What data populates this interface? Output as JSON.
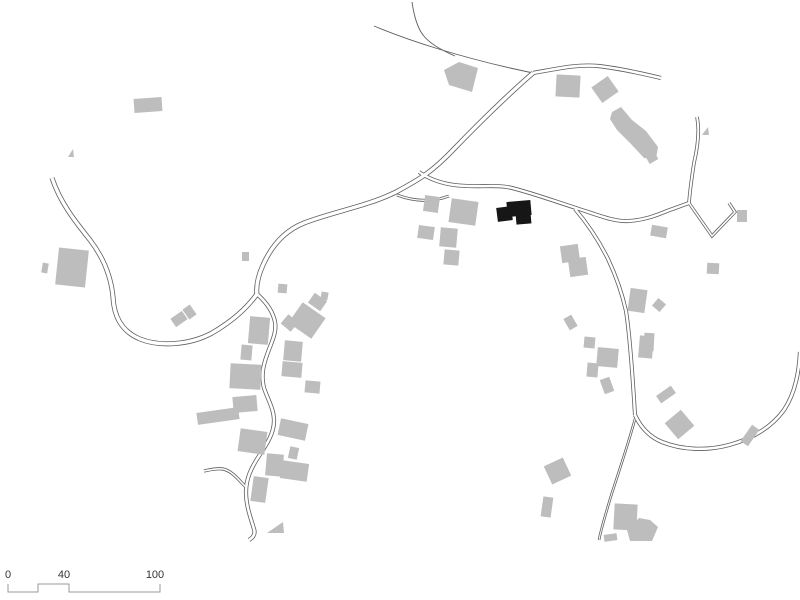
{
  "page": {
    "title": "Village site plan (figure-ground map)",
    "background": "#ffffff"
  },
  "colors": {
    "building_fill": "#bdbdbd",
    "highlight_fill": "#161616",
    "road_line": "#5f5f5f",
    "road_fill": "#ffffff",
    "scalebar_line": "#9a9a9a",
    "label_text": "#333333"
  },
  "map": {
    "width": 800,
    "height": 600,
    "roads": [
      {
        "name": "northwest-road",
        "w": 5.0,
        "d": "M 52,178 C 60,202 74,220 90,240 C 103,257 111,276 113,297 C 114,316 121,331 140,339 C 160,347 190,345 212,333 C 231,322 247,308 257,294"
      },
      {
        "name": "main-sweep-road",
        "w": 5.0,
        "d": "M 533,73 C 510,93 480,122 453,150 C 432,172 420,179 396,192 C 368,206 332,212 304,223 C 284,231 271,247 263,265 C 258,276 256,287 257,295"
      },
      {
        "name": "village-street",
        "w": 4.2,
        "d": "M 258,295 C 267,303 273,312 275,322 C 277,333 271,343 267,355 C 263,366 261,376 264,388 C 268,400 274,409 274,421 C 274,433 267,444 259,456 C 251,468 246,479 246,492 C 246,506 251,519 254,529 C 256,535 252,538 249,540"
      },
      {
        "name": "street-spur",
        "w": 3.2,
        "d": "M 247,488 C 240,482 233,471 223,469 C 216,468 209,470 204,471"
      },
      {
        "name": "top-diagonal-path",
        "w": 1.0,
        "single": true,
        "d": "M 374,26 C 412,42 462,57 510,68 L 533,73"
      },
      {
        "name": "top-curve-path",
        "w": 1.0,
        "single": true,
        "d": "M 412,2 C 414,16 417,27 423,35 C 429,43 441,50 455,56"
      },
      {
        "name": "east-road",
        "w": 4.2,
        "d": "M 533,73 C 556,69 577,64 598,66 C 618,68 640,73 661,78"
      },
      {
        "name": "middle-east-road",
        "w": 4.0,
        "d": "M 419,172 C 429,179 440,183 454,185 C 477,188 496,184 512,188 C 532,193 554,201 576,208 C 598,215 614,222 629,221 C 644,220 655,216 667,211 L 689,203"
      },
      {
        "name": "north-lane",
        "w": 3.6,
        "d": "M 697,117 C 700,132 697,150 694,163 C 692,176 690,189 689,203"
      },
      {
        "name": "zigzag-lane",
        "w": 3.2,
        "d": "M 689,203 L 712,236 L 735,212 L 729,203"
      },
      {
        "name": "south-descent-road",
        "w": 4.0,
        "d": "M 575,209 C 587,223 599,241 608,259 C 616,276 622,293 626,311 C 630,336 633,382 635,415"
      },
      {
        "name": "southeast-branch-road",
        "w": 4.2,
        "d": "M 635,415 C 641,428 650,437 662,442 C 682,450 707,451 729,445 C 751,439 771,428 784,410 C 794,395 799,374 800,352"
      },
      {
        "name": "south-lane",
        "w": 2.6,
        "d": "M 635,419 C 628,445 619,471 611,496 C 606,513 601,529 599,540"
      },
      {
        "name": "junction-link",
        "w": 3.0,
        "d": "M 397,195 C 413,201 430,203 449,196"
      }
    ],
    "buildings": [
      {
        "k": "r",
        "x": 134,
        "y": 98,
        "w": 28,
        "h": 14,
        "rot": -4
      },
      {
        "k": "p",
        "pts": "68,157 73,149 74,157"
      },
      {
        "k": "r",
        "x": 57,
        "y": 249,
        "w": 30,
        "h": 37,
        "rot": 6
      },
      {
        "k": "r",
        "x": 42,
        "y": 263,
        "w": 6,
        "h": 10,
        "rot": 10
      },
      {
        "k": "p",
        "pts": "444,70 459,62 478,68 472,92 449,85"
      },
      {
        "k": "r",
        "x": 556,
        "y": 75,
        "w": 24,
        "h": 22,
        "rot": 3
      },
      {
        "k": "r",
        "x": 595,
        "y": 80,
        "w": 20,
        "h": 19,
        "rot": -35
      },
      {
        "k": "p",
        "pts": "612,112 621,107 632,120 646,131 658,147 656,159 644,158 631,144 617,130 610,119"
      },
      {
        "k": "r",
        "x": 647,
        "y": 154,
        "w": 10,
        "h": 8,
        "rot": -30
      },
      {
        "k": "p",
        "pts": "702,135 708,127 709,135"
      },
      {
        "k": "r",
        "x": 424,
        "y": 196,
        "w": 15,
        "h": 16,
        "rot": 8
      },
      {
        "k": "r",
        "x": 450,
        "y": 200,
        "w": 27,
        "h": 24,
        "rot": 8
      },
      {
        "k": "r",
        "x": 418,
        "y": 226,
        "w": 16,
        "h": 13,
        "rot": 8
      },
      {
        "k": "r",
        "x": 440,
        "y": 228,
        "w": 17,
        "h": 19,
        "rot": 5
      },
      {
        "k": "r",
        "x": 444,
        "y": 250,
        "w": 15,
        "h": 15,
        "rot": 5
      },
      {
        "k": "r",
        "x": 561,
        "y": 245,
        "w": 18,
        "h": 17,
        "rot": -8
      },
      {
        "k": "r",
        "x": 569,
        "y": 258,
        "w": 18,
        "h": 18,
        "rot": -8
      },
      {
        "k": "r",
        "x": 651,
        "y": 226,
        "w": 16,
        "h": 11,
        "rot": 10
      },
      {
        "k": "r",
        "x": 707,
        "y": 263,
        "w": 12,
        "h": 11,
        "rot": 3
      },
      {
        "k": "r",
        "x": 737,
        "y": 210,
        "w": 10,
        "h": 12,
        "rot": 0
      },
      {
        "k": "r",
        "x": 249,
        "y": 317,
        "w": 20,
        "h": 27,
        "rot": 5
      },
      {
        "k": "r",
        "x": 241,
        "y": 345,
        "w": 11,
        "h": 15,
        "rot": 5
      },
      {
        "k": "r",
        "x": 230,
        "y": 364,
        "w": 31,
        "h": 25,
        "rot": 3
      },
      {
        "k": "r",
        "x": 233,
        "y": 396,
        "w": 24,
        "h": 16,
        "rot": -5
      },
      {
        "k": "r",
        "x": 197,
        "y": 410,
        "w": 42,
        "h": 12,
        "rot": -8
      },
      {
        "k": "r",
        "x": 283,
        "y": 317,
        "w": 13,
        "h": 12,
        "rot": 40
      },
      {
        "k": "r",
        "x": 293,
        "y": 308,
        "w": 28,
        "h": 25,
        "rot": 35
      },
      {
        "k": "r",
        "x": 310,
        "y": 296,
        "w": 15,
        "h": 12,
        "rot": 35
      },
      {
        "k": "r",
        "x": 321,
        "y": 292,
        "w": 7,
        "h": 8,
        "rot": 10
      },
      {
        "k": "r",
        "x": 284,
        "y": 341,
        "w": 18,
        "h": 20,
        "rot": 5
      },
      {
        "k": "r",
        "x": 282,
        "y": 362,
        "w": 20,
        "h": 15,
        "rot": 5
      },
      {
        "k": "r",
        "x": 305,
        "y": 381,
        "w": 15,
        "h": 12,
        "rot": 5
      },
      {
        "k": "r",
        "x": 279,
        "y": 421,
        "w": 28,
        "h": 17,
        "rot": 12
      },
      {
        "k": "r",
        "x": 289,
        "y": 447,
        "w": 9,
        "h": 12,
        "rot": 12
      },
      {
        "k": "r",
        "x": 266,
        "y": 454,
        "w": 17,
        "h": 22,
        "rot": 5
      },
      {
        "k": "r",
        "x": 281,
        "y": 462,
        "w": 27,
        "h": 18,
        "rot": 8
      },
      {
        "k": "r",
        "x": 252,
        "y": 477,
        "w": 15,
        "h": 25,
        "rot": 8
      },
      {
        "k": "r",
        "x": 239,
        "y": 430,
        "w": 27,
        "h": 23,
        "rot": 8
      },
      {
        "k": "p",
        "pts": "267,533 283,522 284,533"
      },
      {
        "k": "r",
        "x": 242,
        "y": 252,
        "w": 7,
        "h": 9,
        "rot": 0
      },
      {
        "k": "r",
        "x": 278,
        "y": 284,
        "w": 9,
        "h": 9,
        "rot": 5
      },
      {
        "k": "r",
        "x": 172,
        "y": 314,
        "w": 14,
        "h": 10,
        "rot": -35
      },
      {
        "k": "r",
        "x": 185,
        "y": 306,
        "w": 9,
        "h": 12,
        "rot": -35
      },
      {
        "k": "r",
        "x": 566,
        "y": 316,
        "w": 9,
        "h": 13,
        "rot": -30
      },
      {
        "k": "r",
        "x": 584,
        "y": 337,
        "w": 11,
        "h": 11,
        "rot": 5
      },
      {
        "k": "r",
        "x": 597,
        "y": 348,
        "w": 21,
        "h": 19,
        "rot": 5
      },
      {
        "k": "r",
        "x": 587,
        "y": 363,
        "w": 11,
        "h": 14,
        "rot": 5
      },
      {
        "k": "r",
        "x": 602,
        "y": 378,
        "w": 10,
        "h": 15,
        "rot": -20
      },
      {
        "k": "r",
        "x": 639,
        "y": 336,
        "w": 14,
        "h": 22,
        "rot": 5
      },
      {
        "k": "r",
        "x": 657,
        "y": 390,
        "w": 18,
        "h": 9,
        "rot": -35
      },
      {
        "k": "r",
        "x": 669,
        "y": 414,
        "w": 21,
        "h": 21,
        "rot": -40
      },
      {
        "k": "r",
        "x": 740,
        "y": 431,
        "w": 20,
        "h": 9,
        "rot": -55
      },
      {
        "k": "r",
        "x": 547,
        "y": 461,
        "w": 21,
        "h": 20,
        "rot": -25
      },
      {
        "k": "r",
        "x": 542,
        "y": 497,
        "w": 10,
        "h": 20,
        "rot": 8
      },
      {
        "k": "r",
        "x": 614,
        "y": 504,
        "w": 23,
        "h": 26,
        "rot": 3
      },
      {
        "k": "p",
        "pts": "627,530 639,518 650,520 658,527 652,541 630,541"
      },
      {
        "k": "r",
        "x": 604,
        "y": 534,
        "w": 13,
        "h": 7,
        "rot": -8
      },
      {
        "k": "r",
        "x": 629,
        "y": 289,
        "w": 17,
        "h": 23,
        "rot": 8
      },
      {
        "k": "r",
        "x": 654,
        "y": 300,
        "w": 10,
        "h": 10,
        "rot": 40
      },
      {
        "k": "r",
        "x": 644,
        "y": 333,
        "w": 10,
        "h": 18,
        "rot": 3
      }
    ],
    "highlight_building": [
      {
        "k": "r",
        "x": 497,
        "y": 207,
        "w": 15,
        "h": 14,
        "rot": -7
      },
      {
        "k": "r",
        "x": 507,
        "y": 201,
        "w": 24,
        "h": 15,
        "rot": -5
      },
      {
        "k": "r",
        "x": 516,
        "y": 213,
        "w": 15,
        "h": 11,
        "rot": -5
      }
    ],
    "scalebar": {
      "path": "M 8,584 L 8,592 L 38,592 L 38,584 L 69,584 L 69,592 L 160,592 L 160,584",
      "labels": [
        {
          "text": "0",
          "x": 8,
          "y": 578
        },
        {
          "text": "40",
          "x": 64,
          "y": 578
        },
        {
          "text": "100",
          "x": 155,
          "y": 578
        }
      ]
    }
  }
}
